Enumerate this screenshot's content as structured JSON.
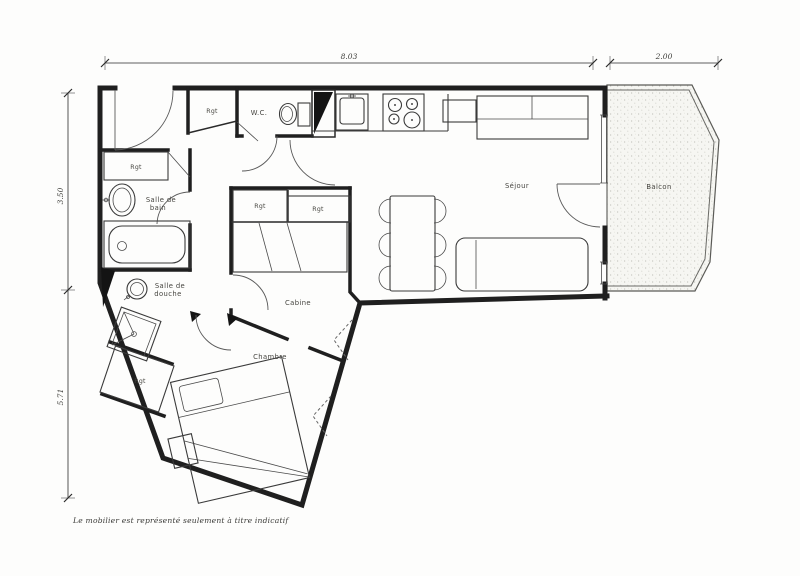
{
  "page": {
    "background": "#fdfdfc"
  },
  "palette": {
    "ink": "#1f1f1f",
    "fixture_line": "#3a3a3a",
    "label": "#45443f",
    "balcony_fill": "#f6f6f2",
    "stipple": "#c3c3bc"
  },
  "dimensions": {
    "top_main": "8.03",
    "top_balcony": "2.00",
    "left_upper": "3.50",
    "left_lower": "5.71"
  },
  "rooms": {
    "wc": "W.C.",
    "sejour": "Séjour",
    "balcon": "Balcon",
    "cabine": "Cabine",
    "chambre": "Chambre",
    "rgt": "Rgt",
    "salle_de_bain_l1": "Salle de",
    "salle_de_bain_l2": "bain",
    "salle_de_douche_l1": "Salle de",
    "salle_de_douche_l2": "douche"
  },
  "caption": "Le mobilier est représenté seulement à titre indicatif"
}
